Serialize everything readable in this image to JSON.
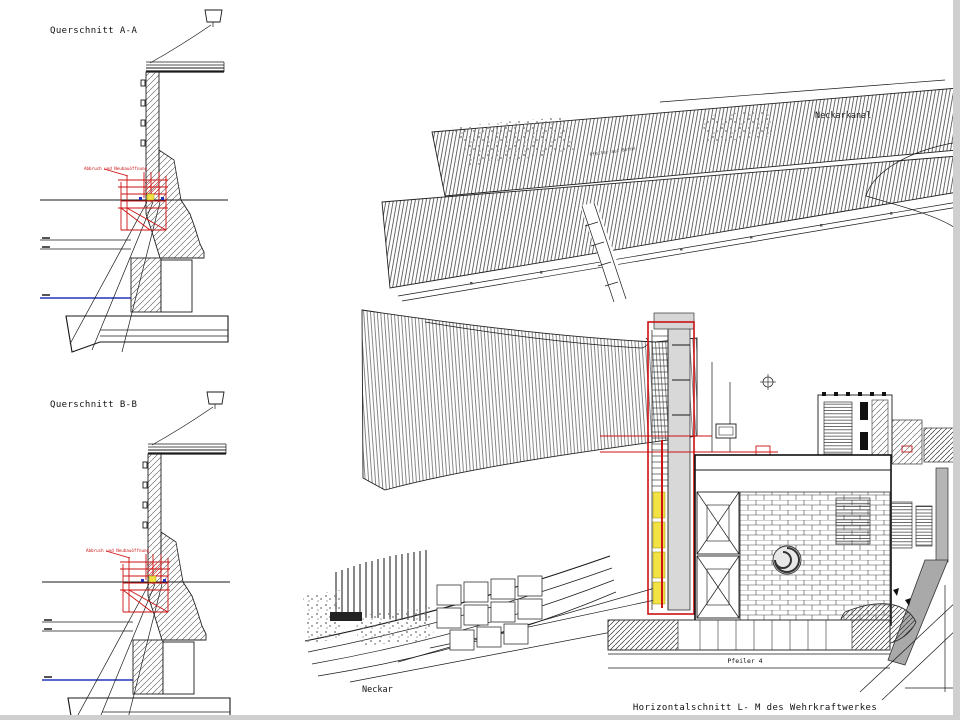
{
  "window": {
    "edge_color": "#cfcfcf"
  },
  "colors": {
    "red": "#cc1111",
    "blue": "#2233bb",
    "yellow": "#f2e246"
  },
  "sections": {
    "a": {
      "title": "Querschnitt A-A",
      "red_note": "Abbruch und Neubauöffnung"
    },
    "b": {
      "title": "Querschnitt B-B",
      "red_note": "Abbruch und Neubauöffnung"
    }
  },
  "plan": {
    "canal_label": "Neckarkanal",
    "river_label": "Neckar",
    "caption": "Horizontalschnitt L- M des Wehrkraftwerkes",
    "pier_label": "Pfeiler 4",
    "slope_label": "Pfeiler auf Beton"
  }
}
